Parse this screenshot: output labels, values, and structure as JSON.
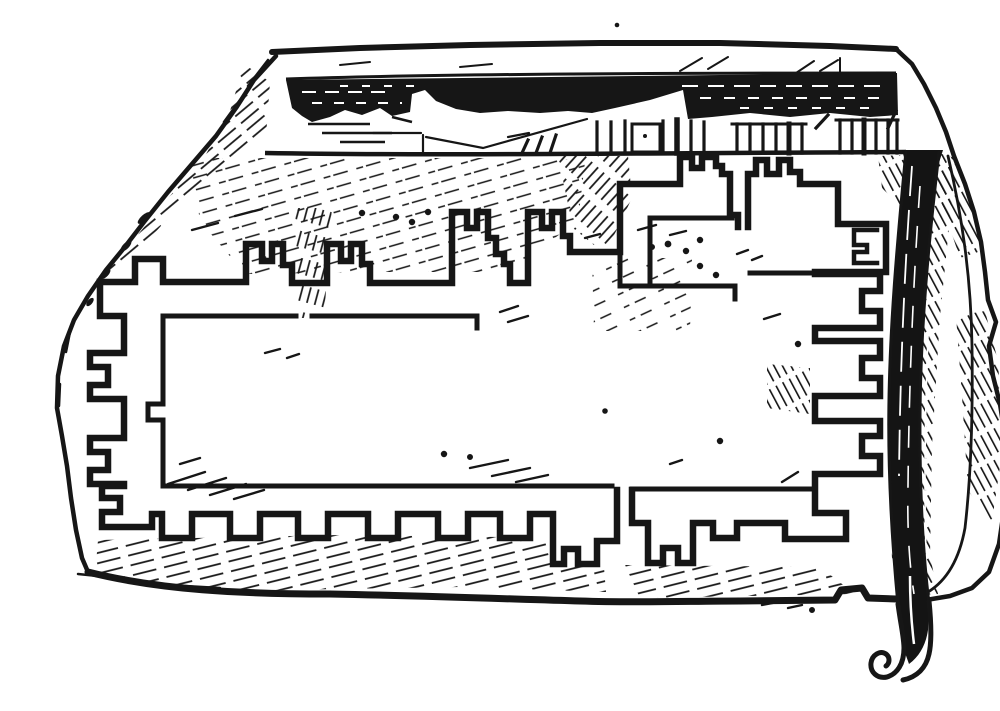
{
  "figure": {
    "alt_text": "Black-and-white engraving of a broken stone tablet. Along its top edge runs a damaged relief band with a graduated measuring rule of small tick marks. The face of the tablet bears a deeply incised plan of a rectangular fortified enclosure with stepped crenellated towers, bastions and gates on all four sides. A long slender stylus with a curled hooked tip hangs down across the right side of the tablet, overlapping its lower edge. The stone is rendered with sketchy pen hatching.",
    "ink_color": "#161616",
    "paper_color": "#ffffff",
    "elements": {
      "tablet": "broken stone tablet",
      "relief_band": "damaged dark relief band along the top edge",
      "ruler": "graduated rule with groups of tick marks",
      "plan": "incised plan of a walled enclosure with stepped towers and gates",
      "gate_mark": "small square gate symbol with hooked glyph at upper right of plan",
      "stylus": "long stylus with curled tip hanging over the right edge"
    }
  }
}
